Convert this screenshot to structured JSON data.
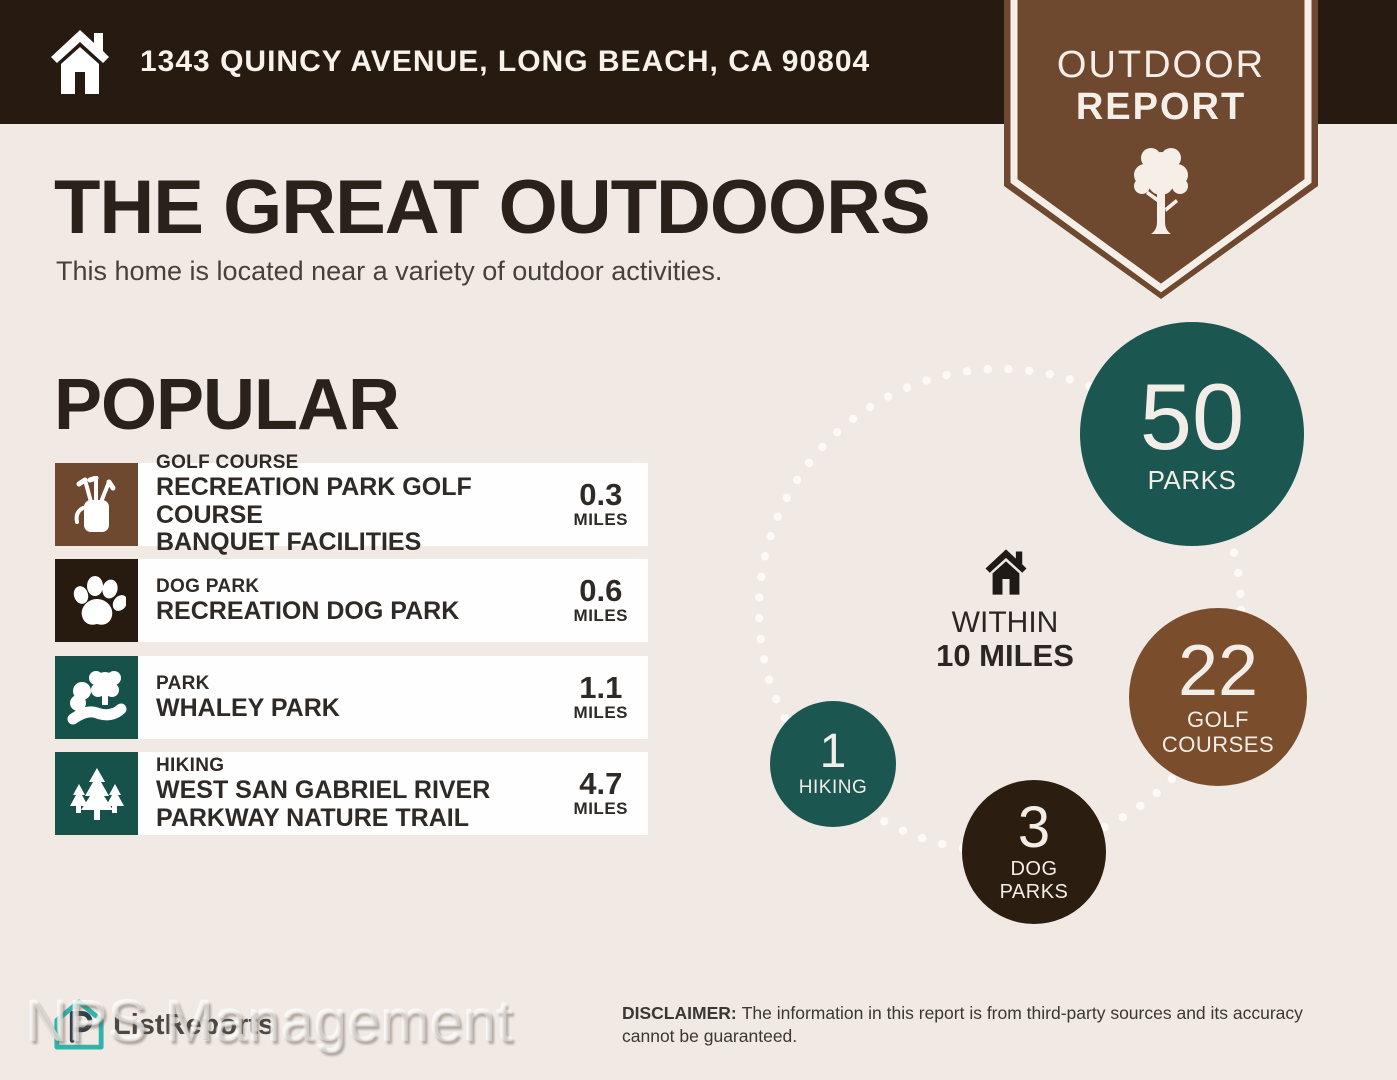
{
  "header": {
    "address": "1343 QUINCY AVENUE, LONG BEACH, CA 90804"
  },
  "badge": {
    "line1": "OUTDOOR",
    "line2": "REPORT",
    "icon": "tree-icon"
  },
  "intro": {
    "title": "THE GREAT OUTDOORS",
    "subtitle": "This home is located near a variety of outdoor activities."
  },
  "popular": {
    "heading": "POPULAR",
    "items": [
      {
        "category": "GOLF COURSE",
        "name": "RECREATION PARK GOLF COURSE\nBANQUET FACILITIES",
        "distance": "0.3",
        "unit": "MILES",
        "icon": "golf-bag-icon",
        "color": "#6e4930"
      },
      {
        "category": "DOG PARK",
        "name": "RECREATION DOG PARK",
        "distance": "0.6",
        "unit": "MILES",
        "icon": "paw-icon",
        "color": "#271b10"
      },
      {
        "category": "PARK",
        "name": "WHALEY PARK",
        "distance": "1.1",
        "unit": "MILES",
        "icon": "park-path-icon",
        "color": "#16514a"
      },
      {
        "category": "HIKING",
        "name": "WEST SAN GABRIEL RIVER\nPARKWAY NATURE TRAIL",
        "distance": "4.7",
        "unit": "MILES",
        "icon": "pine-trees-icon",
        "color": "#16514a"
      }
    ]
  },
  "radar": {
    "center": {
      "icon": "home-icon",
      "line1": "WITHIN",
      "line2": "10 MILES"
    },
    "bubbles": [
      {
        "value": "50",
        "label": "PARKS",
        "color": "#1c5650"
      },
      {
        "value": "22",
        "label": "GOLF\nCOURSES",
        "color": "#7a4e2c"
      },
      {
        "value": "3",
        "label": "DOG\nPARKS",
        "color": "#2b1e11"
      },
      {
        "value": "1",
        "label": "HIKING",
        "color": "#1c5650"
      }
    ]
  },
  "footer": {
    "logo_text": "ListReports",
    "watermark": "NPS Management",
    "disclaimer_label": "DISCLAIMER:",
    "disclaimer_text": "The information in this report is from third-party sources and its accuracy cannot be guaranteed."
  },
  "colors": {
    "background": "#f0e9e4",
    "header_bar": "#261a11",
    "badge_brown": "#6f4830",
    "teal": "#1c5650",
    "dark_brown": "#271b10",
    "bubble_brown": "#7a4e2c",
    "row_white": "#fefefe",
    "logo_teal": "#2fb3ab"
  }
}
